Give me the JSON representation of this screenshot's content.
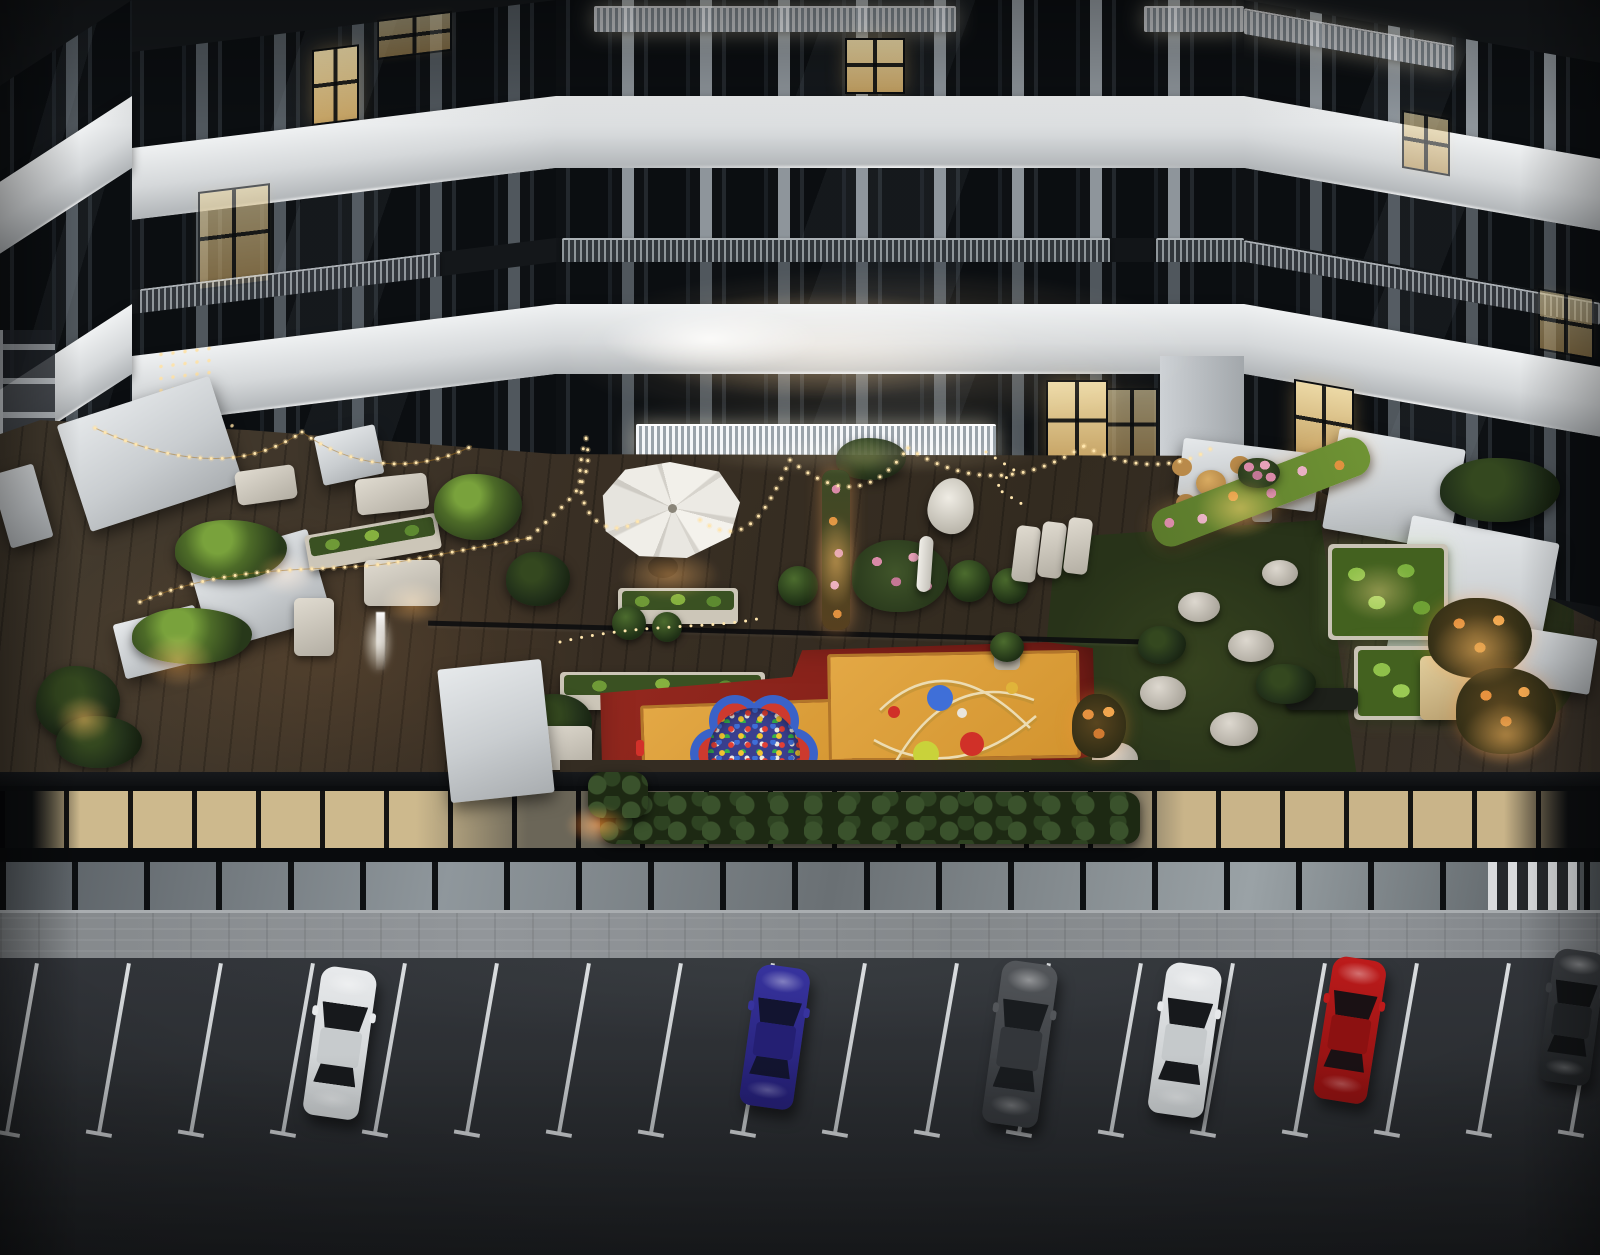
{
  "meta": {
    "title": "Aerial dusk rendering of a residential courtyard with rooftop amenity terrace, children's playground and street parking",
    "type": "3D architectural visualization",
    "time_of_day": "dusk"
  },
  "palette": {
    "facade_band": "#dfe2e4",
    "facade_dark": "#15181b",
    "window_glass": "#101316",
    "warm_window": "#d8bd86",
    "deck_wood": "#392f24",
    "lawn": "#2e3a1c",
    "awning": "#d9dcdf",
    "playground_red": "#8e2621",
    "playground_orange": "#dd9e3c",
    "asphalt": "#2c2f32",
    "sidewalk": "#888c8f",
    "parking_line": "#d7dadd",
    "string_light": "#ffe1a0",
    "glow_warm": "#ffb45e"
  },
  "building": {
    "facade": "white horizontal slab bands with LED underglow over dark glazed floors",
    "wings": "U-shaped block wrapping the courtyard, left and right wings in perspective",
    "balconies": "lit glass-and-steel railing bands",
    "lit_windows": "scattered warm interior lights"
  },
  "terrace": {
    "deck": "dark wood plank amenity deck",
    "amenities": [
      "white retractable awnings",
      "octagonal patio umbrella",
      "festoon string lights",
      "planter boxes",
      "outdoor lounge seating",
      "sun loungers",
      "hanging hammock chair",
      "closed parasol",
      "topiary and cypress trees",
      "flower hedges",
      "lawn with white pouf seats",
      "rattan bistro set",
      "fire-lit seating nook"
    ]
  },
  "playground": {
    "surface": [
      "red safety mat",
      "orange-yellow play mats"
    ],
    "equipment": [
      "flower-shaped ball pit with multicolor balls",
      "arched climbing structure with play spheres"
    ],
    "ball_colors": [
      "#3f6fd8",
      "#d03028",
      "#c9d23a",
      "#e8c93a",
      "#efeae2"
    ]
  },
  "street": {
    "ground_floor": "glazed storefronts, warm lit interiors",
    "sidewalk": "gray paver sidewalk"
  },
  "parking": {
    "surface": "dark asphalt",
    "marking_color": "#d7dadd",
    "lines": {
      "count": 18,
      "x_start": 20,
      "spacing": 92,
      "top_y": 962,
      "length": 172,
      "angle_deg": 10
    },
    "cars": [
      {
        "name": "white-sedan",
        "color_name": "white",
        "body": "#e8eaec",
        "roof": "#c7cbcd",
        "glass": "#17191c",
        "x": 312,
        "y": 968,
        "w": 56,
        "h": 150,
        "angle": 8
      },
      {
        "name": "blue-sedan",
        "color_name": "blue",
        "body": "#37339e",
        "roof": "#241f73",
        "glass": "#121430",
        "x": 748,
        "y": 966,
        "w": 54,
        "h": 142,
        "angle": 8
      },
      {
        "name": "gray-suv",
        "color_name": "dark-gray",
        "body": "#53565a",
        "roof": "#33363a",
        "glass": "#191c1f",
        "x": 992,
        "y": 962,
        "w": 56,
        "h": 164,
        "angle": 8
      },
      {
        "name": "white-sedan-2",
        "color_name": "white",
        "body": "#e6e8ea",
        "roof": "#c5c9cb",
        "glass": "#17191c",
        "x": 1157,
        "y": 964,
        "w": 56,
        "h": 152,
        "angle": 8
      },
      {
        "name": "red-coupe",
        "color_name": "red",
        "body": "#bd1b1b",
        "roof": "#8c1111",
        "glass": "#1a1114",
        "x": 1323,
        "y": 958,
        "w": 54,
        "h": 144,
        "angle": 9
      },
      {
        "name": "dark-car-partial",
        "color_name": "dark-gray",
        "body": "#3c3f43",
        "roof": "#24272a",
        "glass": "#121416",
        "x": 1546,
        "y": 950,
        "w": 52,
        "h": 134,
        "angle": 8
      }
    ]
  }
}
